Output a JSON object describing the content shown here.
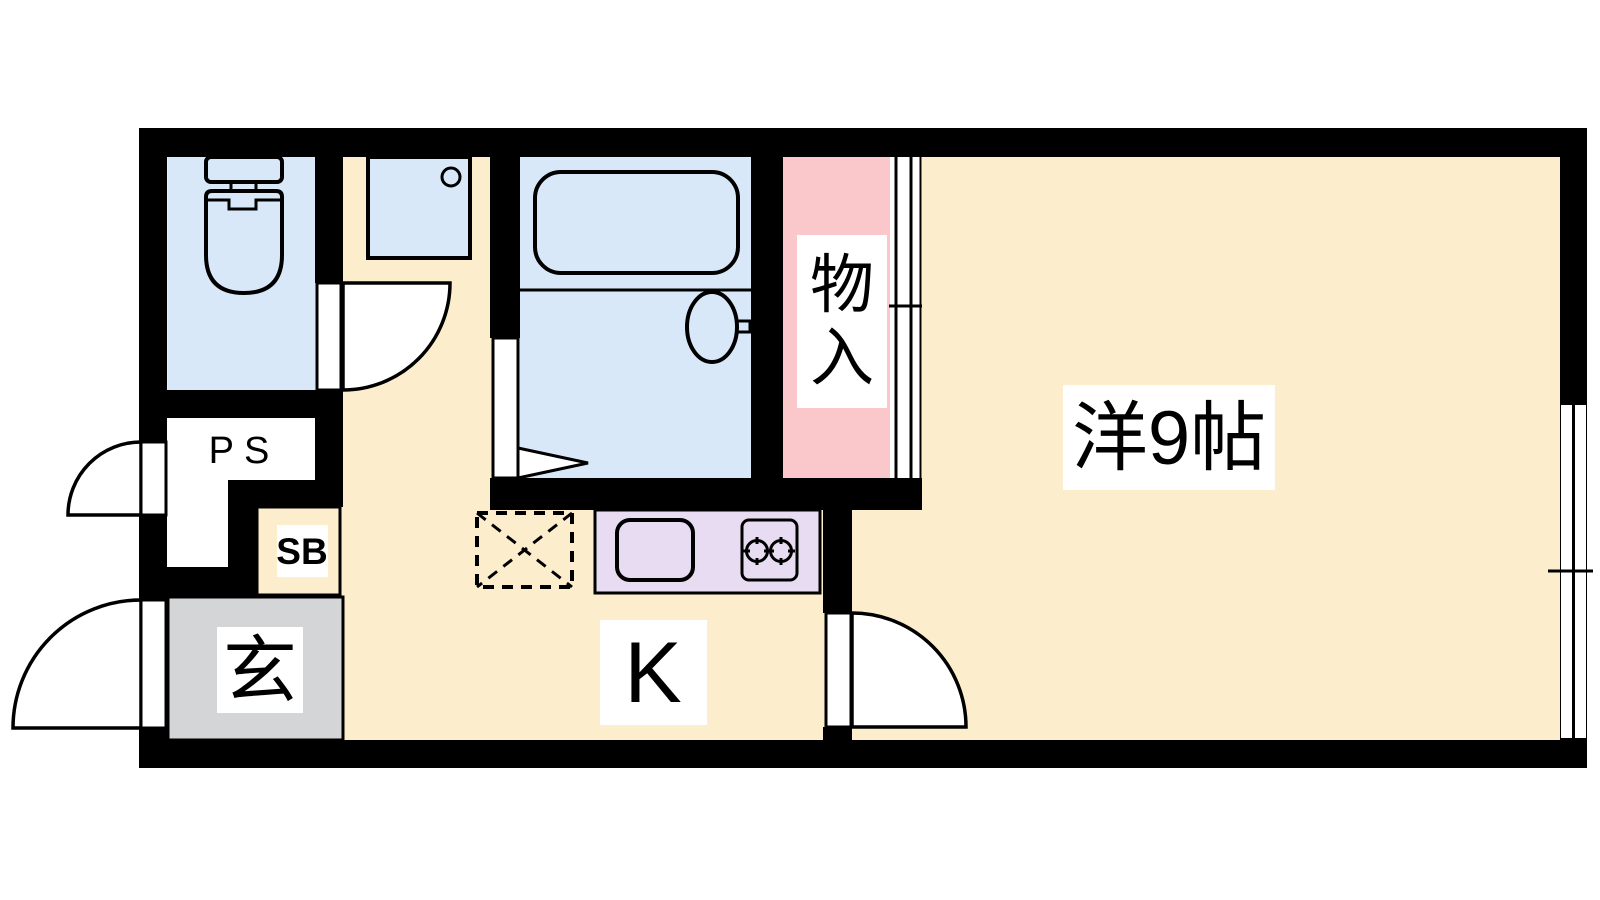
{
  "plan": {
    "type": "apartment-floor-plan-1K",
    "unit_labels": {
      "main_room": "洋9帖",
      "kitchen": "K",
      "entrance": "玄",
      "storage": {
        "label": "物入",
        "chars": [
          "物",
          "入"
        ]
      },
      "pipe_space": "PS",
      "shoe_box": "SB"
    },
    "colors": {
      "floor": "#FCEECD",
      "wet_area": "#D9E8F8",
      "storage_pink": "#FAC8CB",
      "kitchen_counter": "#E8DCF2",
      "entrance_gray": "#D4D5D7",
      "wall": "#000000",
      "label_bg": "#FFFFFF"
    }
  }
}
